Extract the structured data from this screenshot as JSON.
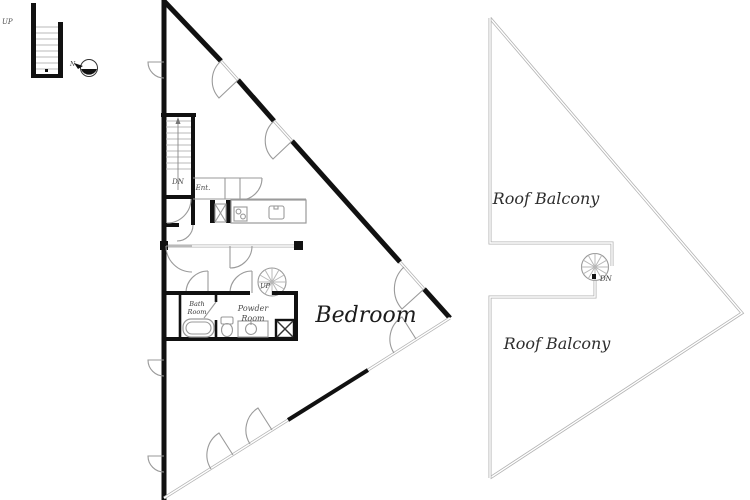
{
  "document": {
    "type": "architectural-floor-plan",
    "plans": [
      "upper-floor",
      "roof-floor"
    ]
  },
  "legend": {
    "stair_up_label": "UP",
    "north_label": "N"
  },
  "plan_left": {
    "bedroom_label": "Bedroom",
    "entrance_label": "Ent.",
    "stair_down_label": "DN",
    "spiral_up_label": "UP",
    "bath_room_line1": "Bath",
    "bath_room_line2": "Room",
    "powder_room_line1": "Powder",
    "powder_room_line2": "Room"
  },
  "plan_right": {
    "roof_balcony_upper_label": "Roof Balcony",
    "roof_balcony_lower_label": "Roof Balcony",
    "spiral_down_label": "DN"
  },
  "colors": {
    "wall": "#111111",
    "thin_line": "#b3b3b3",
    "mid_line": "#9a9a9a",
    "text": "#3a3a3a",
    "background": "#ffffff"
  }
}
